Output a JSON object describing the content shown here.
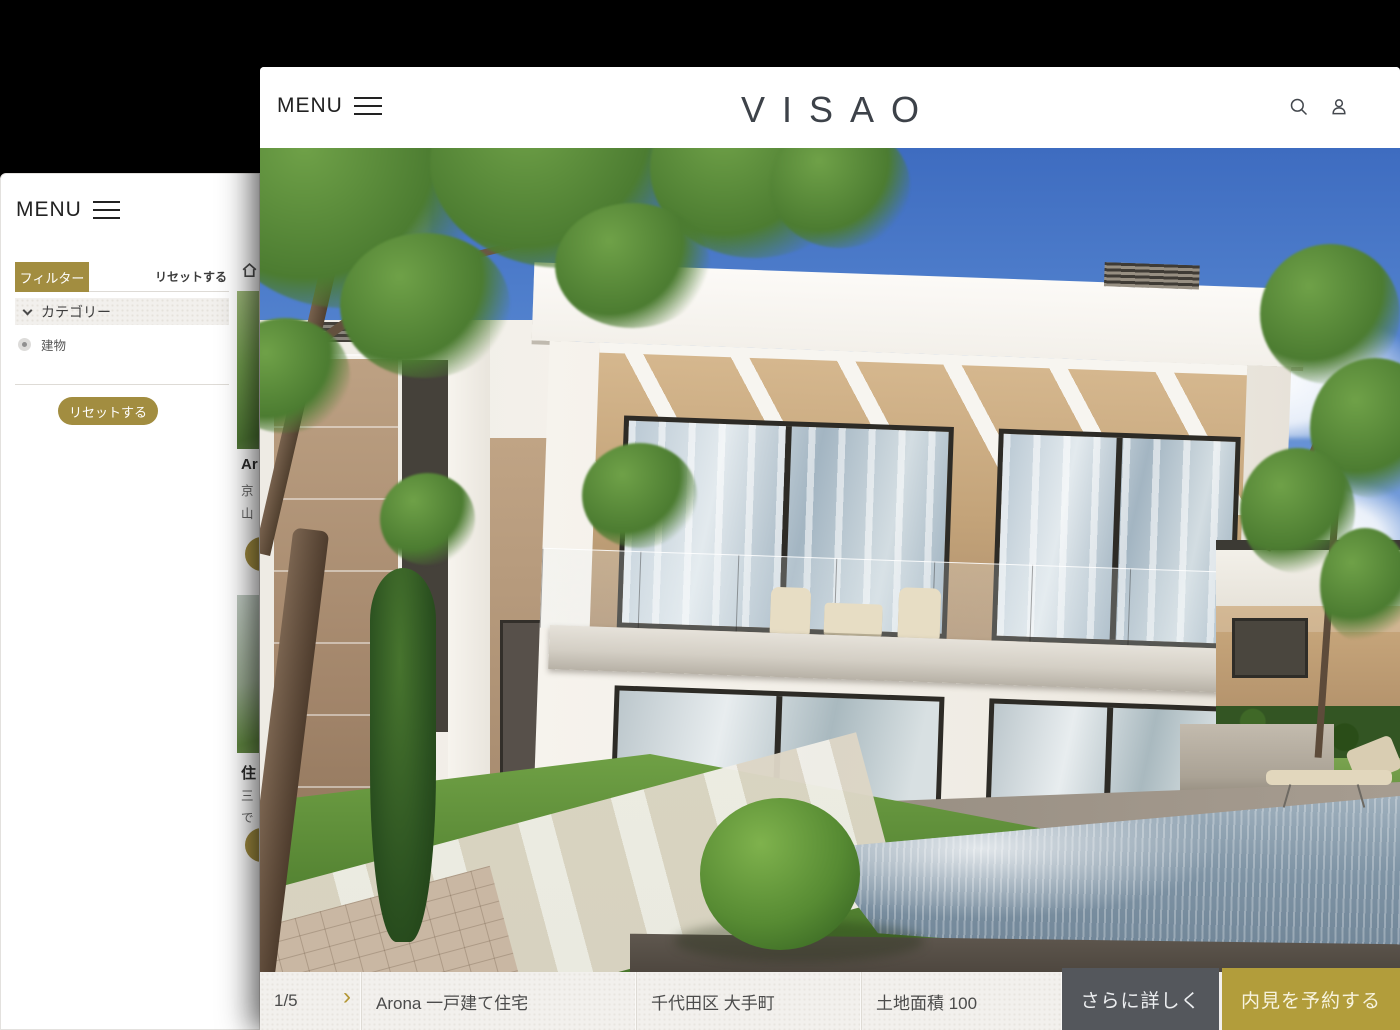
{
  "colors": {
    "gold_accent": "#a28d40",
    "gold_button": "#b29d3b",
    "dark_button": "#54575c",
    "bar_background": "#f2f0ed",
    "logo_color": "#3d4249"
  },
  "icons": {
    "hamburger": "three-lines",
    "search": "magnifier",
    "user": "person-outline",
    "home": "house",
    "chevron_down": "v",
    "radio": "dot-in-circle"
  },
  "back_window": {
    "menu_label": "MENU",
    "filter_panel": {
      "filter_tab_label": "フィルター",
      "reset_link_label": "リセットする",
      "category_header_label": "カテゴリー",
      "category_option_label": "建物",
      "reset_button_label": "リセットする"
    },
    "listing_fragments": {
      "card1_title": "Ar",
      "card1_line1": "京",
      "card1_line2": "山",
      "card2_title": "住",
      "card2_line1": "三",
      "card2_line2": "で"
    }
  },
  "front_window": {
    "header": {
      "menu_label": "MENU",
      "logo_text": "VISAO"
    },
    "photo_pager": {
      "current_page": "1/5",
      "next_chevron": "›"
    },
    "bottom_bar": {
      "property_name": "Arona 一戸建て住宅",
      "location": "千代田区 大手町",
      "land_area": "土地面積 100",
      "details_button_label": "さらに詳しく",
      "booking_button_label": "内見を予約する"
    }
  }
}
